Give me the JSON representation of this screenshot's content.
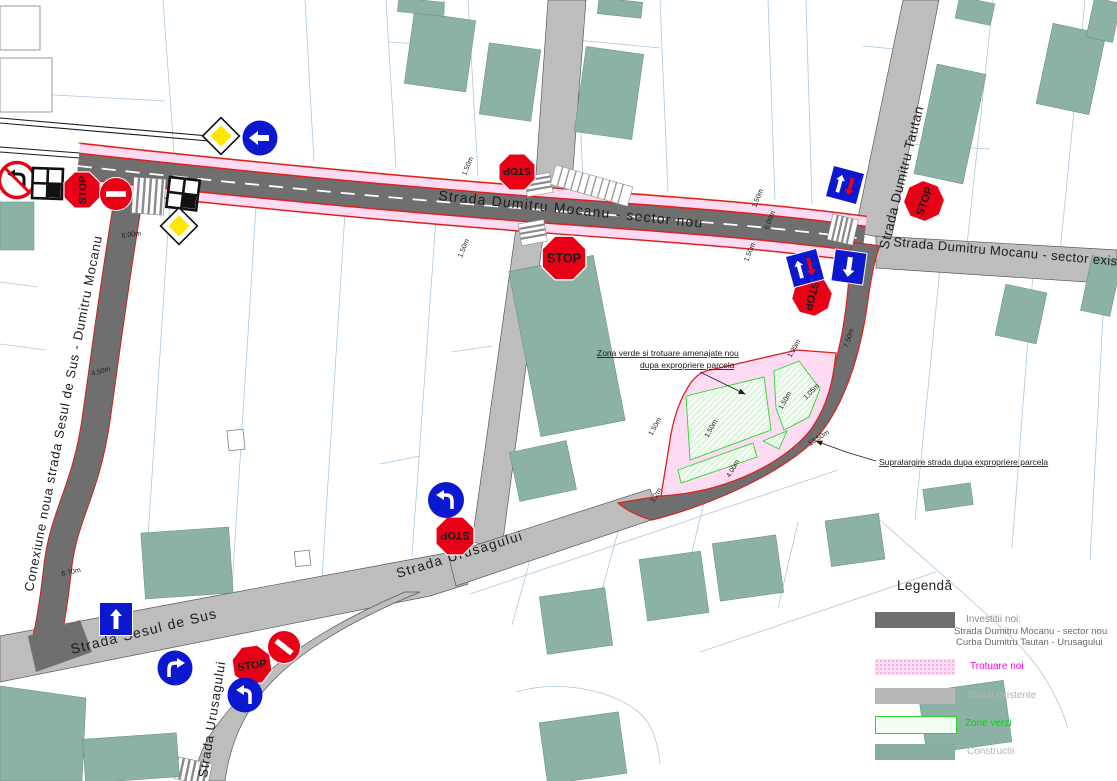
{
  "streets": {
    "mocanu_nou": "Strada Dumitru Mocanu - sector nou",
    "mocanu_exist": "Strada Dumitru Mocanu - sector exist.",
    "tautan": "Strada Dumitru Tautan",
    "urusagului": "Strada Urusagului",
    "urusagului_sud": "Strada Urusagului",
    "sesul": "Strada Sesul de Sus",
    "conexiune": "Conexiune noua strada Sesul de Sus - Dumitru Mocanu"
  },
  "annotations": {
    "zona1": "Zona verde si trotuare amenajate nou",
    "zona2": "dupa expropriere parcela",
    "supralargire": "Supralargire strada dupa expropriere parcela"
  },
  "dimensions": {
    "conexiune_top": "6.00m",
    "conexiune_mid": "4.50m",
    "conexiune_bottom": "6.70m",
    "sidewalk_top": "1.50m",
    "road_width": "6.00m",
    "sidewalk_bottom": "1.50m",
    "crossing_top": "1.50m",
    "crossing_bottom": "1.50m",
    "tautan_width": "7.50m",
    "curve_width": "13.50m",
    "green_left": "1.50m",
    "green_mid": "1.50m",
    "green_right": "1.50m",
    "green_top": "1.90m",
    "green_diag": "1.05m",
    "green_bottom": "4.00m",
    "green_tip": "1.2m"
  },
  "signs": {
    "stop": "STOP"
  },
  "legend": {
    "title": "Legendă",
    "items": [
      {
        "label": "Investitii noi:",
        "sub1": "Strada Dumitru Mocanu - sector nou",
        "sub2": "Curba Dumitru Tautan - Urusagului",
        "swatch": "#6f6f6f",
        "label_color": "#8a8a8a"
      },
      {
        "label": "Trotuare noi",
        "swatch": "#fcdbf3",
        "label_color": "#ff00dd"
      },
      {
        "label": "Strazi existente",
        "swatch": "#b7b7b7",
        "label_color": "#b3b3b3"
      },
      {
        "label": "Zone verzi",
        "swatch": "#f4fff4",
        "label_color": "#00d800"
      },
      {
        "label": "Constructii",
        "swatch": "#87aca0",
        "label_color": "#a9bcb5"
      }
    ]
  },
  "colors": {
    "new_road": "#6f6f6f",
    "existing_road": "#bdbdbd",
    "sidewalk_pink": "#fcdbf3",
    "green_zone": "#f1fcf1",
    "building": "#8cb2a6",
    "sign_red": "#e80016",
    "sign_blue": "#0b18cf",
    "priority_yellow": "#ffe800",
    "edge_red": "#e02020",
    "utility_orange": "#f5a623",
    "parcel_blue": "#abc8df"
  }
}
